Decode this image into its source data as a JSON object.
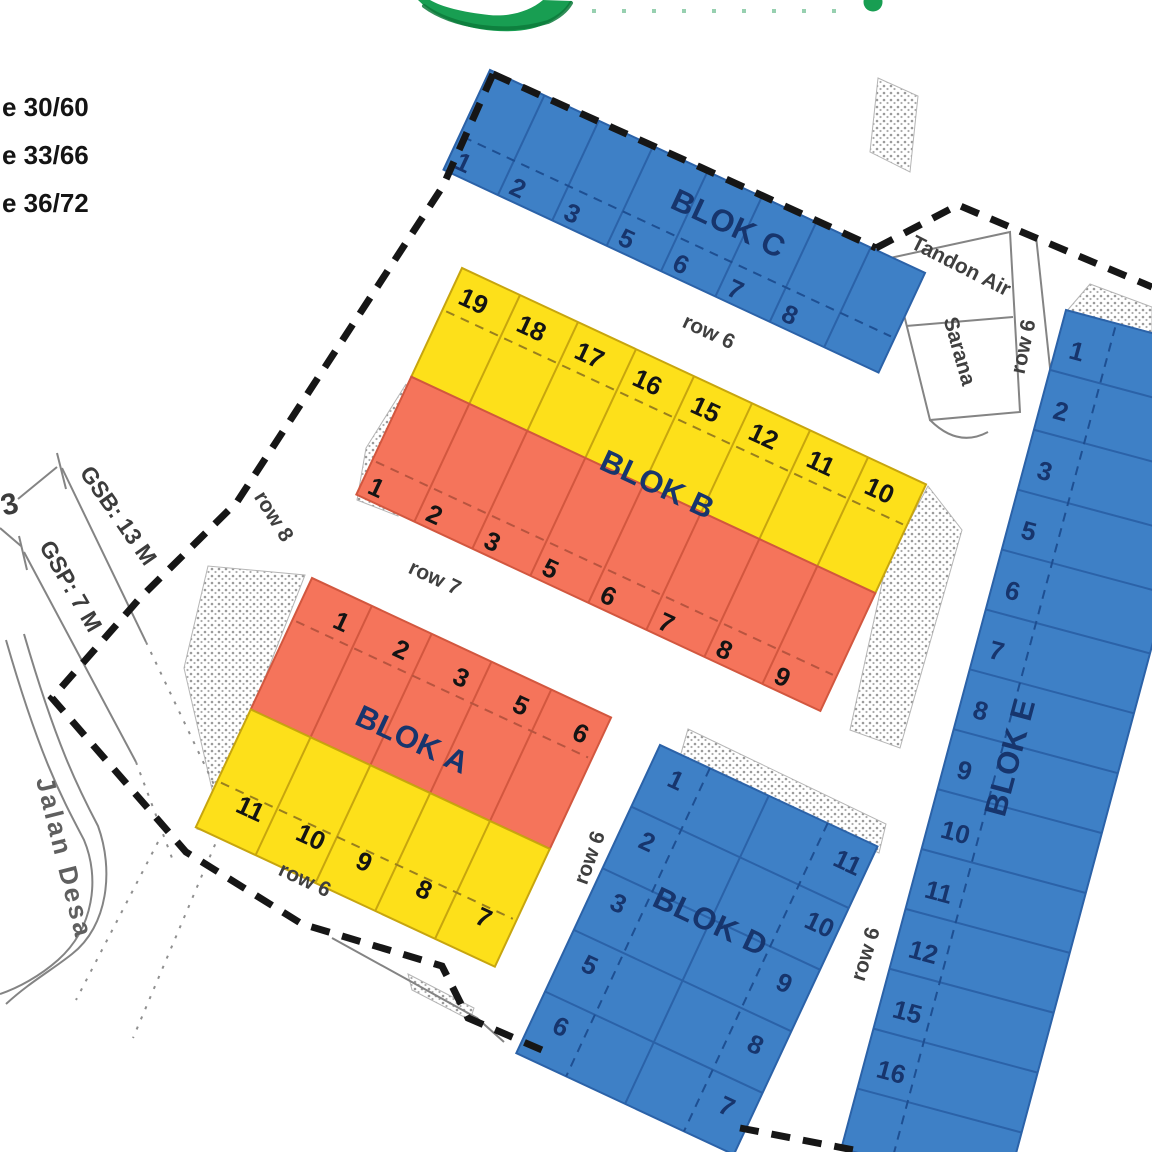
{
  "legend": {
    "items": [
      "e 30/60",
      "e 33/66",
      "e 36/72"
    ]
  },
  "annotations": {
    "left_number": "3",
    "gsb": "GSB: 13 M",
    "gsp": "GSP: 7 M",
    "jalan_desa": "Jalan Desa",
    "row_8": "row 8",
    "row_7": "row 7",
    "row_6": "row 6",
    "tandon_air": "Tandon Air",
    "sarana": "Sarana"
  },
  "blocks": {
    "c": {
      "label": "BLOK C",
      "lots": [
        1,
        2,
        3,
        5,
        6,
        7,
        8
      ]
    },
    "b": {
      "label": "BLOK B",
      "rows": [
        {
          "color_key": "yellow",
          "lots": [
            19,
            18,
            17,
            16,
            15,
            12,
            11,
            10
          ]
        },
        {
          "color_key": "orange",
          "lots": [
            1,
            2,
            3,
            5,
            6,
            7,
            8,
            9
          ]
        }
      ]
    },
    "a": {
      "label": "BLOK A",
      "rows": [
        {
          "color_key": "orange",
          "lots": [
            1,
            2,
            3,
            5,
            6
          ]
        },
        {
          "color_key": "yellow",
          "lots": [
            11,
            10,
            9,
            8,
            7
          ]
        }
      ]
    },
    "d": {
      "label": "BLOK D",
      "columns": [
        [
          1,
          2,
          3,
          5,
          6
        ],
        [
          11,
          10,
          9,
          8,
          7
        ]
      ]
    },
    "e": {
      "label": "BLOK E",
      "lots": [
        1,
        2,
        3,
        5,
        6,
        7,
        8,
        9,
        10,
        11,
        12,
        15,
        16
      ]
    }
  },
  "colors": {
    "blue": "#3e80c6",
    "blue_line": "#2b62a8",
    "blue_dash": "#1e4f92",
    "yellow": "#fde01a",
    "yellow_line": "#c7a50e",
    "orange": "#f5745b",
    "orange_line": "#d2573f",
    "navy": "#17356d",
    "ink": "#161616",
    "number_dark": "#141414",
    "road": "#848484",
    "stipple": "#9a9a9a",
    "green": "#189e52"
  }
}
